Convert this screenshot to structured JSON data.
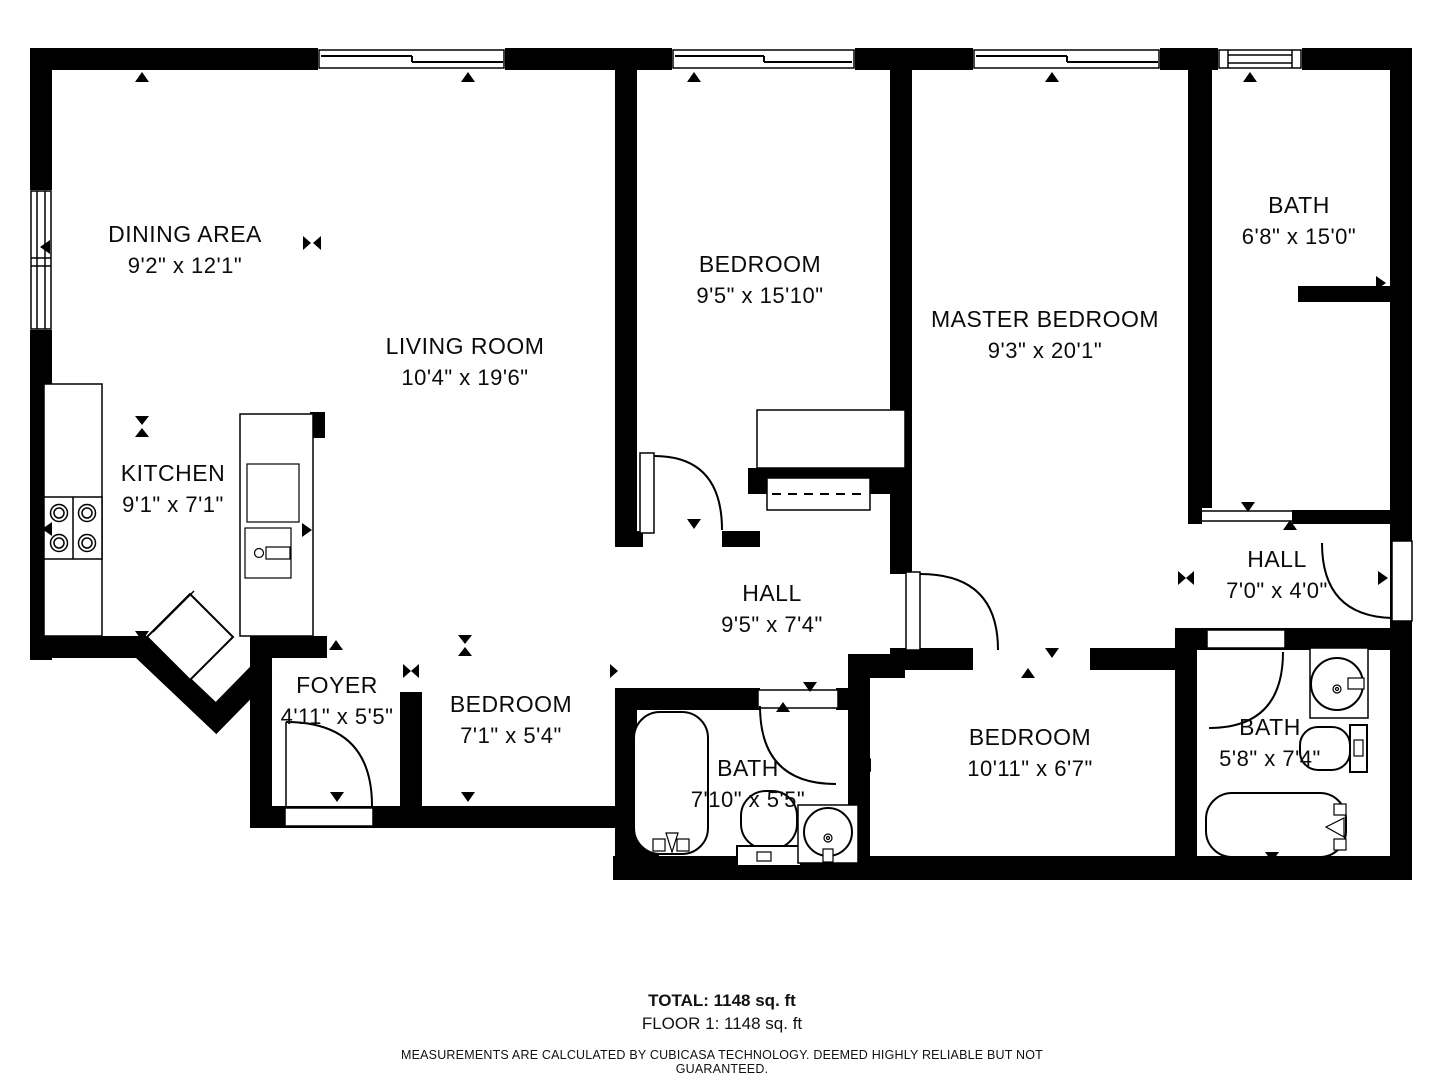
{
  "plan": {
    "rooms": [
      {
        "id": "dining",
        "name": "DINING AREA",
        "dims": "9'2\" x 12'1\""
      },
      {
        "id": "living",
        "name": "LIVING ROOM",
        "dims": "10'4\" x 19'6\""
      },
      {
        "id": "kitchen",
        "name": "KITCHEN",
        "dims": "9'1\" x 7'1\""
      },
      {
        "id": "bedroom-top",
        "name": "BEDROOM",
        "dims": "9'5\" x 15'10\""
      },
      {
        "id": "master",
        "name": "MASTER BEDROOM",
        "dims": "9'3\" x 20'1\""
      },
      {
        "id": "bath-top",
        "name": "BATH",
        "dims": "6'8\" x 15'0\""
      },
      {
        "id": "hall-main",
        "name": "HALL",
        "dims": "9'5\" x 7'4\""
      },
      {
        "id": "hall-right",
        "name": "HALL",
        "dims": "7'0\" x 4'0\""
      },
      {
        "id": "foyer",
        "name": "FOYER",
        "dims": "4'11\" x 5'5\""
      },
      {
        "id": "bedroom-small",
        "name": "BEDROOM",
        "dims": "7'1\" x 5'4\""
      },
      {
        "id": "bath-mid",
        "name": "BATH",
        "dims": "7'10\" x 5'5\""
      },
      {
        "id": "bedroom-bottom",
        "name": "BEDROOM",
        "dims": "10'11\" x 6'7\""
      },
      {
        "id": "bath-right",
        "name": "BATH",
        "dims": "5'8\" x 7'4\""
      }
    ]
  },
  "footer": {
    "total": "TOTAL: 1148 sq. ft",
    "floor": "FLOOR 1: 1148 sq. ft",
    "disclaimer": "MEASUREMENTS ARE CALCULATED BY CUBICASA TECHNOLOGY. DEEMED HIGHLY RELIABLE BUT NOT GUARANTEED."
  },
  "colors": {
    "wall": "#000000",
    "background": "#ffffff",
    "text": "#0b0b0b"
  }
}
